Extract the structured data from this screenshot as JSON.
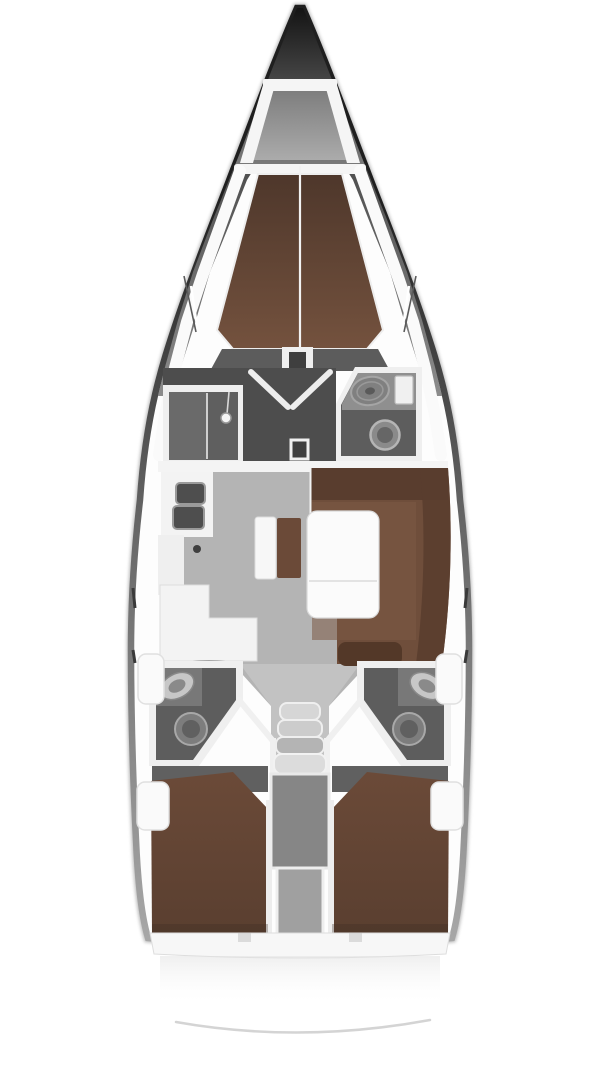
{
  "diagram": {
    "type": "sailing-yacht-interior-floor-plan",
    "orientation": "bow-up",
    "compartments": [
      "anchor-locker",
      "forward-v-berth-cabin",
      "shower-compartment",
      "forward-head",
      "wardrobe-vestibule-with-double-doors",
      "saloon",
      "galley",
      "u-shaped-settee-dinette",
      "port-aft-head",
      "starboard-aft-head",
      "companionway",
      "engine-compartment",
      "port-aft-double-berth-cabin",
      "starboard-aft-double-berth-cabin",
      "stern-swim-platform"
    ],
    "fixtures": [
      "double-galley-sink",
      "l-shaped-counter",
      "saloon-table",
      "side-bench-with-cushion",
      "shower-head",
      "washbasin-forward",
      "toilet-forward",
      "washbasin-port-aft",
      "toilet-port-aft",
      "washbasin-starboard-aft",
      "toilet-starboard-aft",
      "companionway-steps"
    ]
  },
  "colors": {
    "page_bg": "#ffffff",
    "hull_fill": "#fdfdfd",
    "rim_dark": "#1f1f1f",
    "rim_mid": "#666666",
    "rim_light": "#a8a8a8",
    "bow_top": "#141414",
    "bow_mid": "#4a4a4a",
    "bow_bottom": "#7a7a7a",
    "wedge_dark": "#4e4e4e",
    "wedge_light": "#8c8c8c",
    "deck_white": "#f5f5f5",
    "locker_top": "#7c7c7c",
    "locker_bottom": "#ababab",
    "berth_top": "#4e372b",
    "berth_bottom": "#74523e",
    "cabin_floor": "#5c5c5c",
    "room_dark": "#4d4d4d",
    "room_mid": "#6a6a6a",
    "wall_white": "#efefef",
    "counter_white": "#f3f3f3",
    "sink_dark": "#4e4e4e",
    "fixture_light": "#c7c7c7",
    "fixture_mid": "#8a8a8a",
    "fixture_dark": "#5f5f5f",
    "saloon_floor": "#b4b4b4",
    "saloon_floor_light": "#c2c2c2",
    "settee_base": "#6f4e3b",
    "settee_dark": "#593d2e",
    "settee_seat": "#7b5945",
    "cushion_brown": "#6b4a38",
    "table_white": "#fbfbfb",
    "head_floor": "#5d5d5d",
    "head_counter": "#787878",
    "stairs_light": "#d6d6d6",
    "stairs_mid": "#b4b4b4",
    "engine_gray": "#868686",
    "divider_gray": "#a0a0a0",
    "aft_floor": "#606060",
    "aft_berth_top": "#6b4a38",
    "aft_berth_bottom": "#5a3f30",
    "transom_white": "#f7f7f7",
    "platform_line": "#d4d4d4"
  }
}
